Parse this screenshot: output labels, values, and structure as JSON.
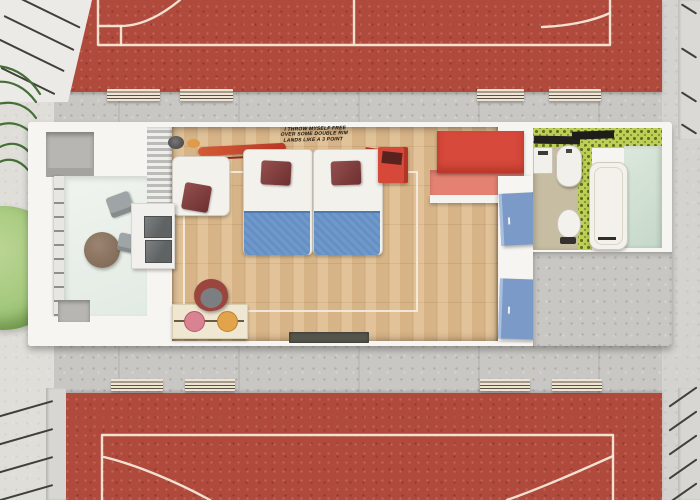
{
  "scene": {
    "description": "Top-down 3D architectural render of a twin-bed hotel room with balcony and bathroom, set between two red sports courts with benches",
    "wall_decal": {
      "lines": [
        "I THROW MYSELF FREE",
        "OVER SOME DOUBLE RIM",
        "LANDS LIKE A 3 POINT"
      ]
    },
    "colors": {
      "court_red": "#b04a3c",
      "court_line_white": "#f4e9d9",
      "pavement_concrete": "#c9c7c3",
      "wall_white": "#f7f5f2",
      "wood_floor": "#ddbb8f",
      "blanket_blue": "#6490c6",
      "pillow_maroon": "#7c3a3b",
      "wardrobe_red": "#d6493b",
      "wardrobe_coral": "#e48173",
      "door_blue": "#7b9ac8",
      "bathroom_tile_green": "#bdd054",
      "bathroom_floor_beige": "#c7bda2",
      "balcony_floor_mint": "#e9efe8",
      "tree_green": "#a3c87c",
      "desk_cream": "#efe7d2",
      "desk_dot_pink": "#d98291",
      "desk_dot_orange": "#e2a44b"
    },
    "areas": {
      "top_court": {
        "label": "sports court (top)",
        "bench_count": 2
      },
      "bottom_court": {
        "label": "sports court (bottom)",
        "bench_count": 2
      },
      "walkways": {
        "top_benches": 2,
        "bottom_benches": 2
      },
      "room": {
        "balcony": {
          "furniture": [
            "round table",
            "chair",
            "chair"
          ],
          "railing": "glass railing"
        },
        "bedroom": {
          "furniture": [
            "twin bed",
            "twin bed",
            "armchair",
            "glass shelf unit",
            "desk",
            "desk chair",
            "surfboard shelf",
            "bedside cabinet",
            "red wardrobe",
            "doormat"
          ]
        },
        "bathroom": {
          "fixtures": [
            "sink",
            "shower screen",
            "water heater",
            "toilet",
            "bathtub"
          ]
        },
        "doors": [
          "blue door (bathroom)",
          "blue door (entry)"
        ]
      },
      "landscape": [
        "tree canopy",
        "palm leaves",
        "perimeter fence"
      ]
    }
  }
}
